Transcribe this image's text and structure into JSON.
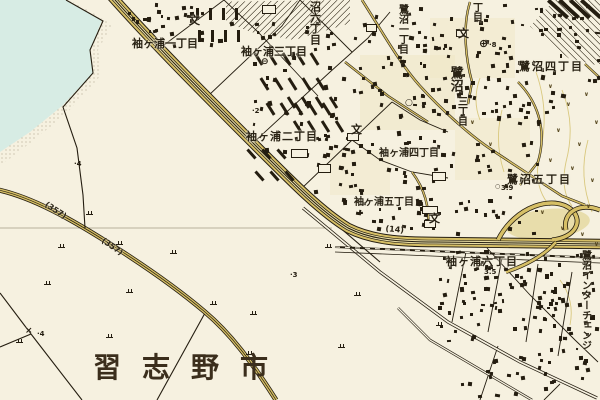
{
  "colors": {
    "background": "#f6f1e0",
    "water": "#d7ece4",
    "road_fill": "#d6bf66",
    "road_fill_light": "#e9dda4",
    "ink": "#241d10",
    "label_ink": "#2a2315",
    "contour": "#d9c87e",
    "city_ink": "#3b2e1c"
  },
  "title_label": {
    "text": "習志野市",
    "x": 93,
    "y": 354,
    "size": 28,
    "spacing": 21
  },
  "area_labels": [
    {
      "text": "袖ヶ浦一丁目",
      "x": 132,
      "y": 38,
      "size": 11,
      "spacing": 0
    },
    {
      "text": "袖ヶ浦三丁目",
      "x": 241,
      "y": 46,
      "size": 11,
      "spacing": 0
    },
    {
      "text": "袖ヶ浦二丁目",
      "x": 246,
      "y": 131,
      "size": 11,
      "spacing": 1
    },
    {
      "text": "袖ヶ浦四丁目",
      "x": 379,
      "y": 149,
      "size": 10,
      "spacing": 0
    },
    {
      "text": "袖ヶ浦五丁目",
      "x": 354,
      "y": 198,
      "size": 10,
      "spacing": 0
    },
    {
      "text": "袖ヶ浦六丁目",
      "x": 446,
      "y": 256,
      "size": 11,
      "spacing": 1
    },
    {
      "text": "鷺沼四丁目",
      "x": 519,
      "y": 61,
      "size": 11,
      "spacing": 2
    },
    {
      "text": "鷺沼五丁目",
      "x": 507,
      "y": 174,
      "size": 11,
      "spacing": 2
    }
  ],
  "vertical_labels": [
    {
      "text": "沼六丁目",
      "x": 309,
      "y": 1,
      "size": 11
    },
    {
      "text": "鷺沼一丁目",
      "x": 396,
      "y": 4,
      "size": 10
    },
    {
      "text": "丁目",
      "x": 470,
      "y": 2,
      "size": 10
    },
    {
      "text": "鷺沼",
      "x": 448,
      "y": 66,
      "size": 13
    },
    {
      "text": "三丁目",
      "x": 455,
      "y": 96,
      "size": 10
    },
    {
      "text": "鷺沼インターチェンジ",
      "x": 579,
      "y": 250,
      "size": 10
    }
  ],
  "route_labels": [
    {
      "text": "(357)",
      "x": 48,
      "y": 200,
      "rotate": 33
    },
    {
      "text": "(357)",
      "x": 105,
      "y": 236,
      "rotate": 35
    },
    {
      "text": "(14)",
      "x": 386,
      "y": 224,
      "rotate": 6
    }
  ],
  "spot_elevations": [
    {
      "text": "·4",
      "x": 74,
      "y": 160
    },
    {
      "text": "·2",
      "x": 252,
      "y": 107
    },
    {
      "text": "·3",
      "x": 290,
      "y": 271
    },
    {
      "text": "·4",
      "x": 37,
      "y": 330
    },
    {
      "text": "·8",
      "x": 489,
      "y": 41
    },
    {
      "text": "3.9",
      "x": 501,
      "y": 184
    },
    {
      "text": "3.5",
      "x": 484,
      "y": 268
    }
  ],
  "symbols": [
    {
      "name": "school-icon",
      "glyph": "文",
      "x": 189,
      "y": 15,
      "size": 11
    },
    {
      "name": "school-icon",
      "glyph": "文",
      "x": 458,
      "y": 28,
      "size": 11
    },
    {
      "name": "school-icon",
      "glyph": "文",
      "x": 351,
      "y": 124,
      "size": 11
    },
    {
      "name": "school-icon",
      "glyph": "文",
      "x": 429,
      "y": 213,
      "size": 11
    },
    {
      "name": "public-office-icon",
      "glyph": "⊕",
      "x": 479,
      "y": 38,
      "size": 11
    },
    {
      "name": "town-office-icon",
      "glyph": "○",
      "x": 405,
      "y": 99,
      "size": 9
    },
    {
      "name": "substation-icon",
      "glyph": "⊖",
      "x": 261,
      "y": 58,
      "size": 9
    },
    {
      "name": "spot-height-circle-icon",
      "glyph": "○",
      "x": 495,
      "y": 184,
      "size": 6
    },
    {
      "name": "water-gate-icon",
      "glyph": "×",
      "x": 25,
      "y": 327,
      "size": 9
    }
  ],
  "marsh_points": [
    [
      86,
      210
    ],
    [
      116,
      240
    ],
    [
      44,
      280
    ],
    [
      126,
      288
    ],
    [
      16,
      338
    ],
    [
      106,
      333
    ],
    [
      170,
      249
    ],
    [
      210,
      300
    ],
    [
      246,
      350
    ],
    [
      325,
      243
    ],
    [
      338,
      343
    ],
    [
      436,
      321
    ],
    [
      354,
      291
    ],
    [
      58,
      243
    ],
    [
      250,
      310
    ]
  ],
  "field_marks": {
    "glyph": "∨",
    "points": [
      [
        548,
        84
      ],
      [
        566,
        102
      ],
      [
        584,
        92
      ],
      [
        556,
        128
      ],
      [
        577,
        142
      ],
      [
        594,
        120
      ],
      [
        548,
        158
      ],
      [
        570,
        166
      ],
      [
        590,
        178
      ],
      [
        540,
        210
      ],
      [
        560,
        226
      ],
      [
        586,
        204
      ],
      [
        470,
        120
      ],
      [
        488,
        142
      ],
      [
        594,
        242
      ],
      [
        580,
        232
      ]
    ]
  },
  "building_clusters": [
    {
      "x": 112,
      "y": 0,
      "w": 58,
      "h": 30,
      "n": 12
    },
    {
      "x": 152,
      "y": 2,
      "w": 88,
      "h": 44,
      "n": 20
    },
    {
      "x": 243,
      "y": 22,
      "w": 100,
      "h": 64,
      "n": 26
    },
    {
      "x": 250,
      "y": 92,
      "w": 92,
      "h": 58,
      "n": 22
    },
    {
      "x": 300,
      "y": 132,
      "w": 62,
      "h": 58,
      "n": 16
    },
    {
      "x": 348,
      "y": 2,
      "w": 250,
      "h": 114,
      "n": 150
    },
    {
      "x": 340,
      "y": 120,
      "w": 205,
      "h": 112,
      "n": 85
    },
    {
      "x": 350,
      "y": 188,
      "w": 88,
      "h": 44,
      "n": 16
    },
    {
      "x": 438,
      "y": 250,
      "w": 158,
      "h": 90,
      "n": 115
    },
    {
      "x": 458,
      "y": 344,
      "w": 138,
      "h": 54,
      "n": 32
    }
  ],
  "bar_rows": [
    {
      "x": 196,
      "y": 8,
      "cols": 4,
      "rows": 2,
      "dx": 13,
      "dy": 22,
      "sx": 2,
      "len": 12,
      "w": 3,
      "angle": 0
    },
    {
      "x": 257,
      "y": 52,
      "cols": 5,
      "rows": 3,
      "dx": 14,
      "dy": 25,
      "sx": 6,
      "len": 14,
      "w": 3,
      "angle": -32
    },
    {
      "x": 290,
      "y": 96,
      "cols": 4,
      "rows": 2,
      "dx": 14,
      "dy": 24,
      "sx": 6,
      "len": 13,
      "w": 3,
      "angle": -32
    },
    {
      "x": 250,
      "y": 148,
      "cols": 3,
      "rows": 2,
      "dx": 15,
      "dy": 22,
      "sx": 8,
      "len": 12,
      "w": 3,
      "angle": -42
    },
    {
      "x": 556,
      "y": -4,
      "cols": 4,
      "rows": 1,
      "dx": 11,
      "dy": 0,
      "sx": 0,
      "len": 26,
      "w": 4,
      "angle": -48
    }
  ],
  "large_buildings": [
    [
      291,
      149,
      17,
      9
    ],
    [
      318,
      164,
      13,
      9
    ],
    [
      262,
      5,
      14,
      9
    ],
    [
      366,
      24,
      11,
      8
    ],
    [
      347,
      133,
      12,
      8
    ],
    [
      424,
      220,
      12,
      8
    ],
    [
      456,
      30,
      11,
      7
    ],
    [
      432,
      172,
      14,
      9
    ],
    [
      422,
      206,
      16,
      8
    ]
  ]
}
